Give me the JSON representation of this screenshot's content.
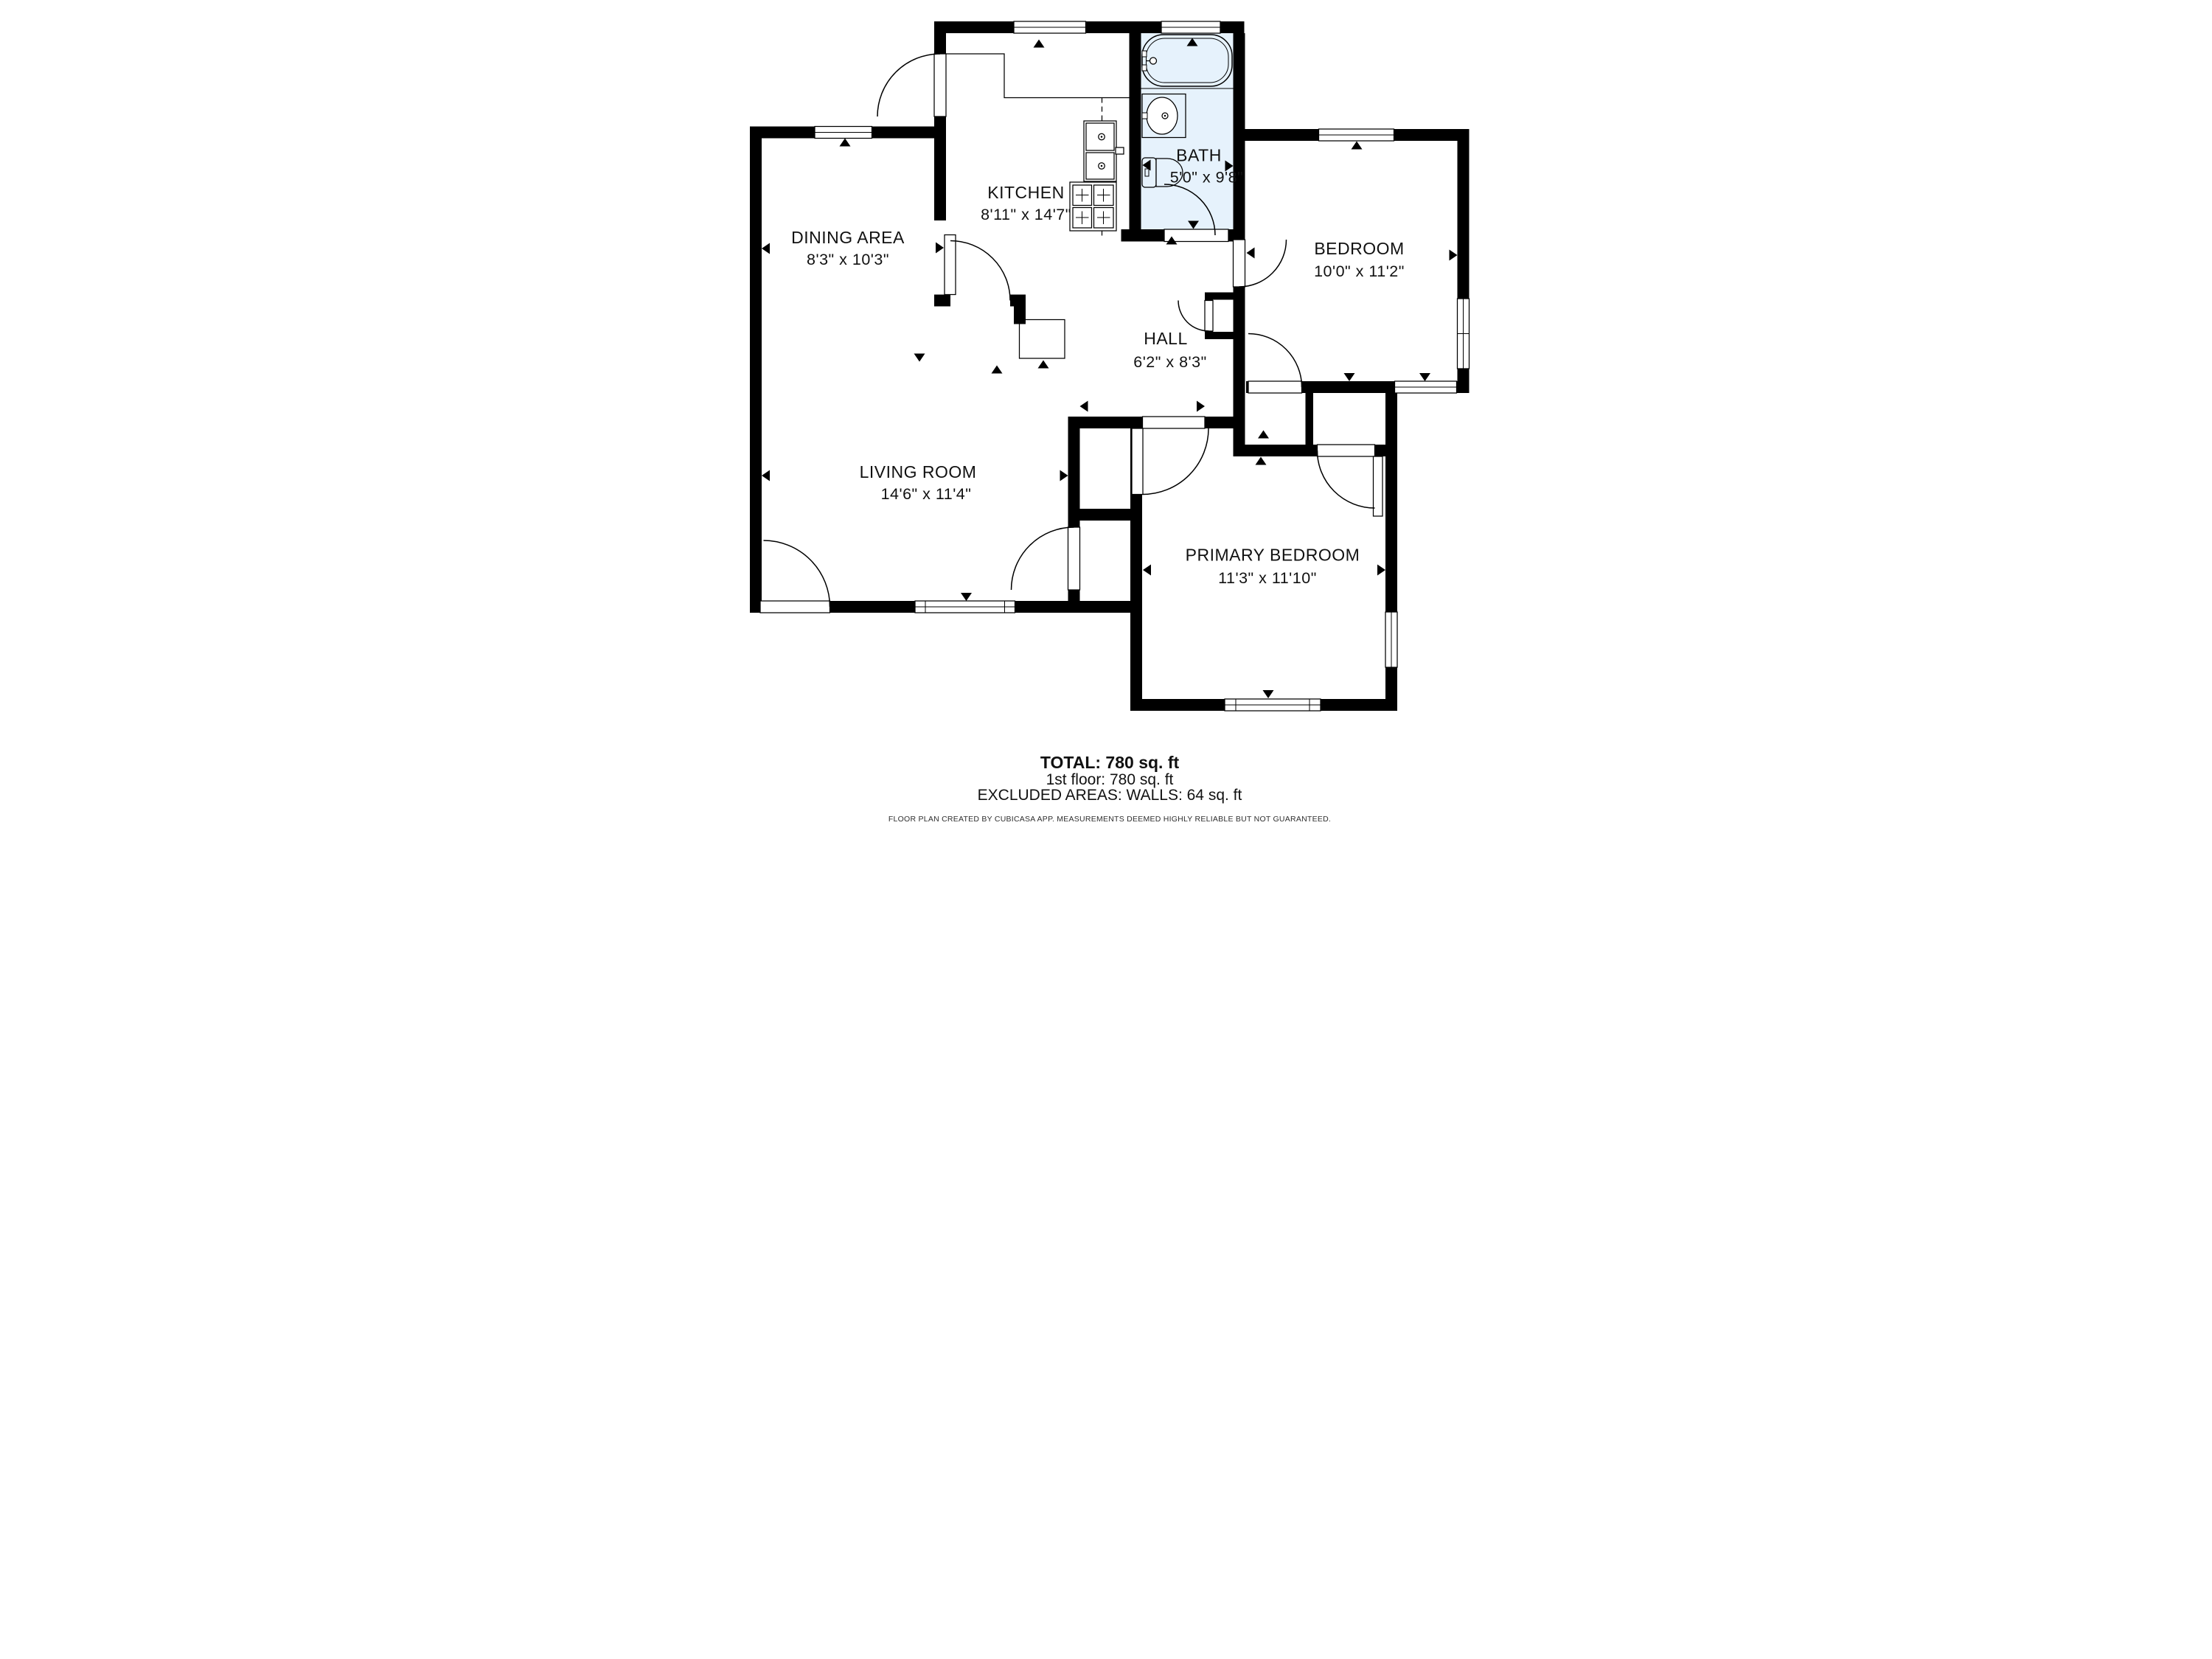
{
  "rooms": {
    "dining": {
      "name": "DINING AREA",
      "dims": "8'3\" x 10'3\""
    },
    "kitchen": {
      "name": "KITCHEN",
      "dims": "8'11\" x 14'7\""
    },
    "bath": {
      "name": "BATH",
      "dims": "5'0\" x 9'8\""
    },
    "bedroom": {
      "name": "BEDROOM",
      "dims": "10'0\" x 11'2\""
    },
    "hall": {
      "name": "HALL",
      "dims": "6'2\" x 8'3\""
    },
    "living": {
      "name": "LIVING ROOM",
      "dims": "14'6\" x 11'4\""
    },
    "primary": {
      "name": "PRIMARY BEDROOM",
      "dims": "11'3\" x 11'10\""
    }
  },
  "summary": {
    "total": "TOTAL: 780 sq. ft",
    "floor": "1st floor: 780 sq. ft",
    "excluded": "EXCLUDED AREAS: WALLS: 64 sq. ft"
  },
  "disclaimer": "FLOOR PLAN CREATED BY CUBICASA APP. MEASUREMENTS DEEMED HIGHLY RELIABLE BUT NOT GUARANTEED.",
  "colors": {
    "wall": "#000000",
    "bath_floor": "#e6f2fc",
    "background": "#ffffff",
    "text": "#111111"
  },
  "icons": {
    "bathtub": "bathtub-icon",
    "bath_sink": "bath-sink-icon",
    "toilet": "toilet-icon",
    "kitchen_sink": "kitchen-sink-icon",
    "stove": "stove-icon",
    "cabinet": "cabinet-icon"
  }
}
